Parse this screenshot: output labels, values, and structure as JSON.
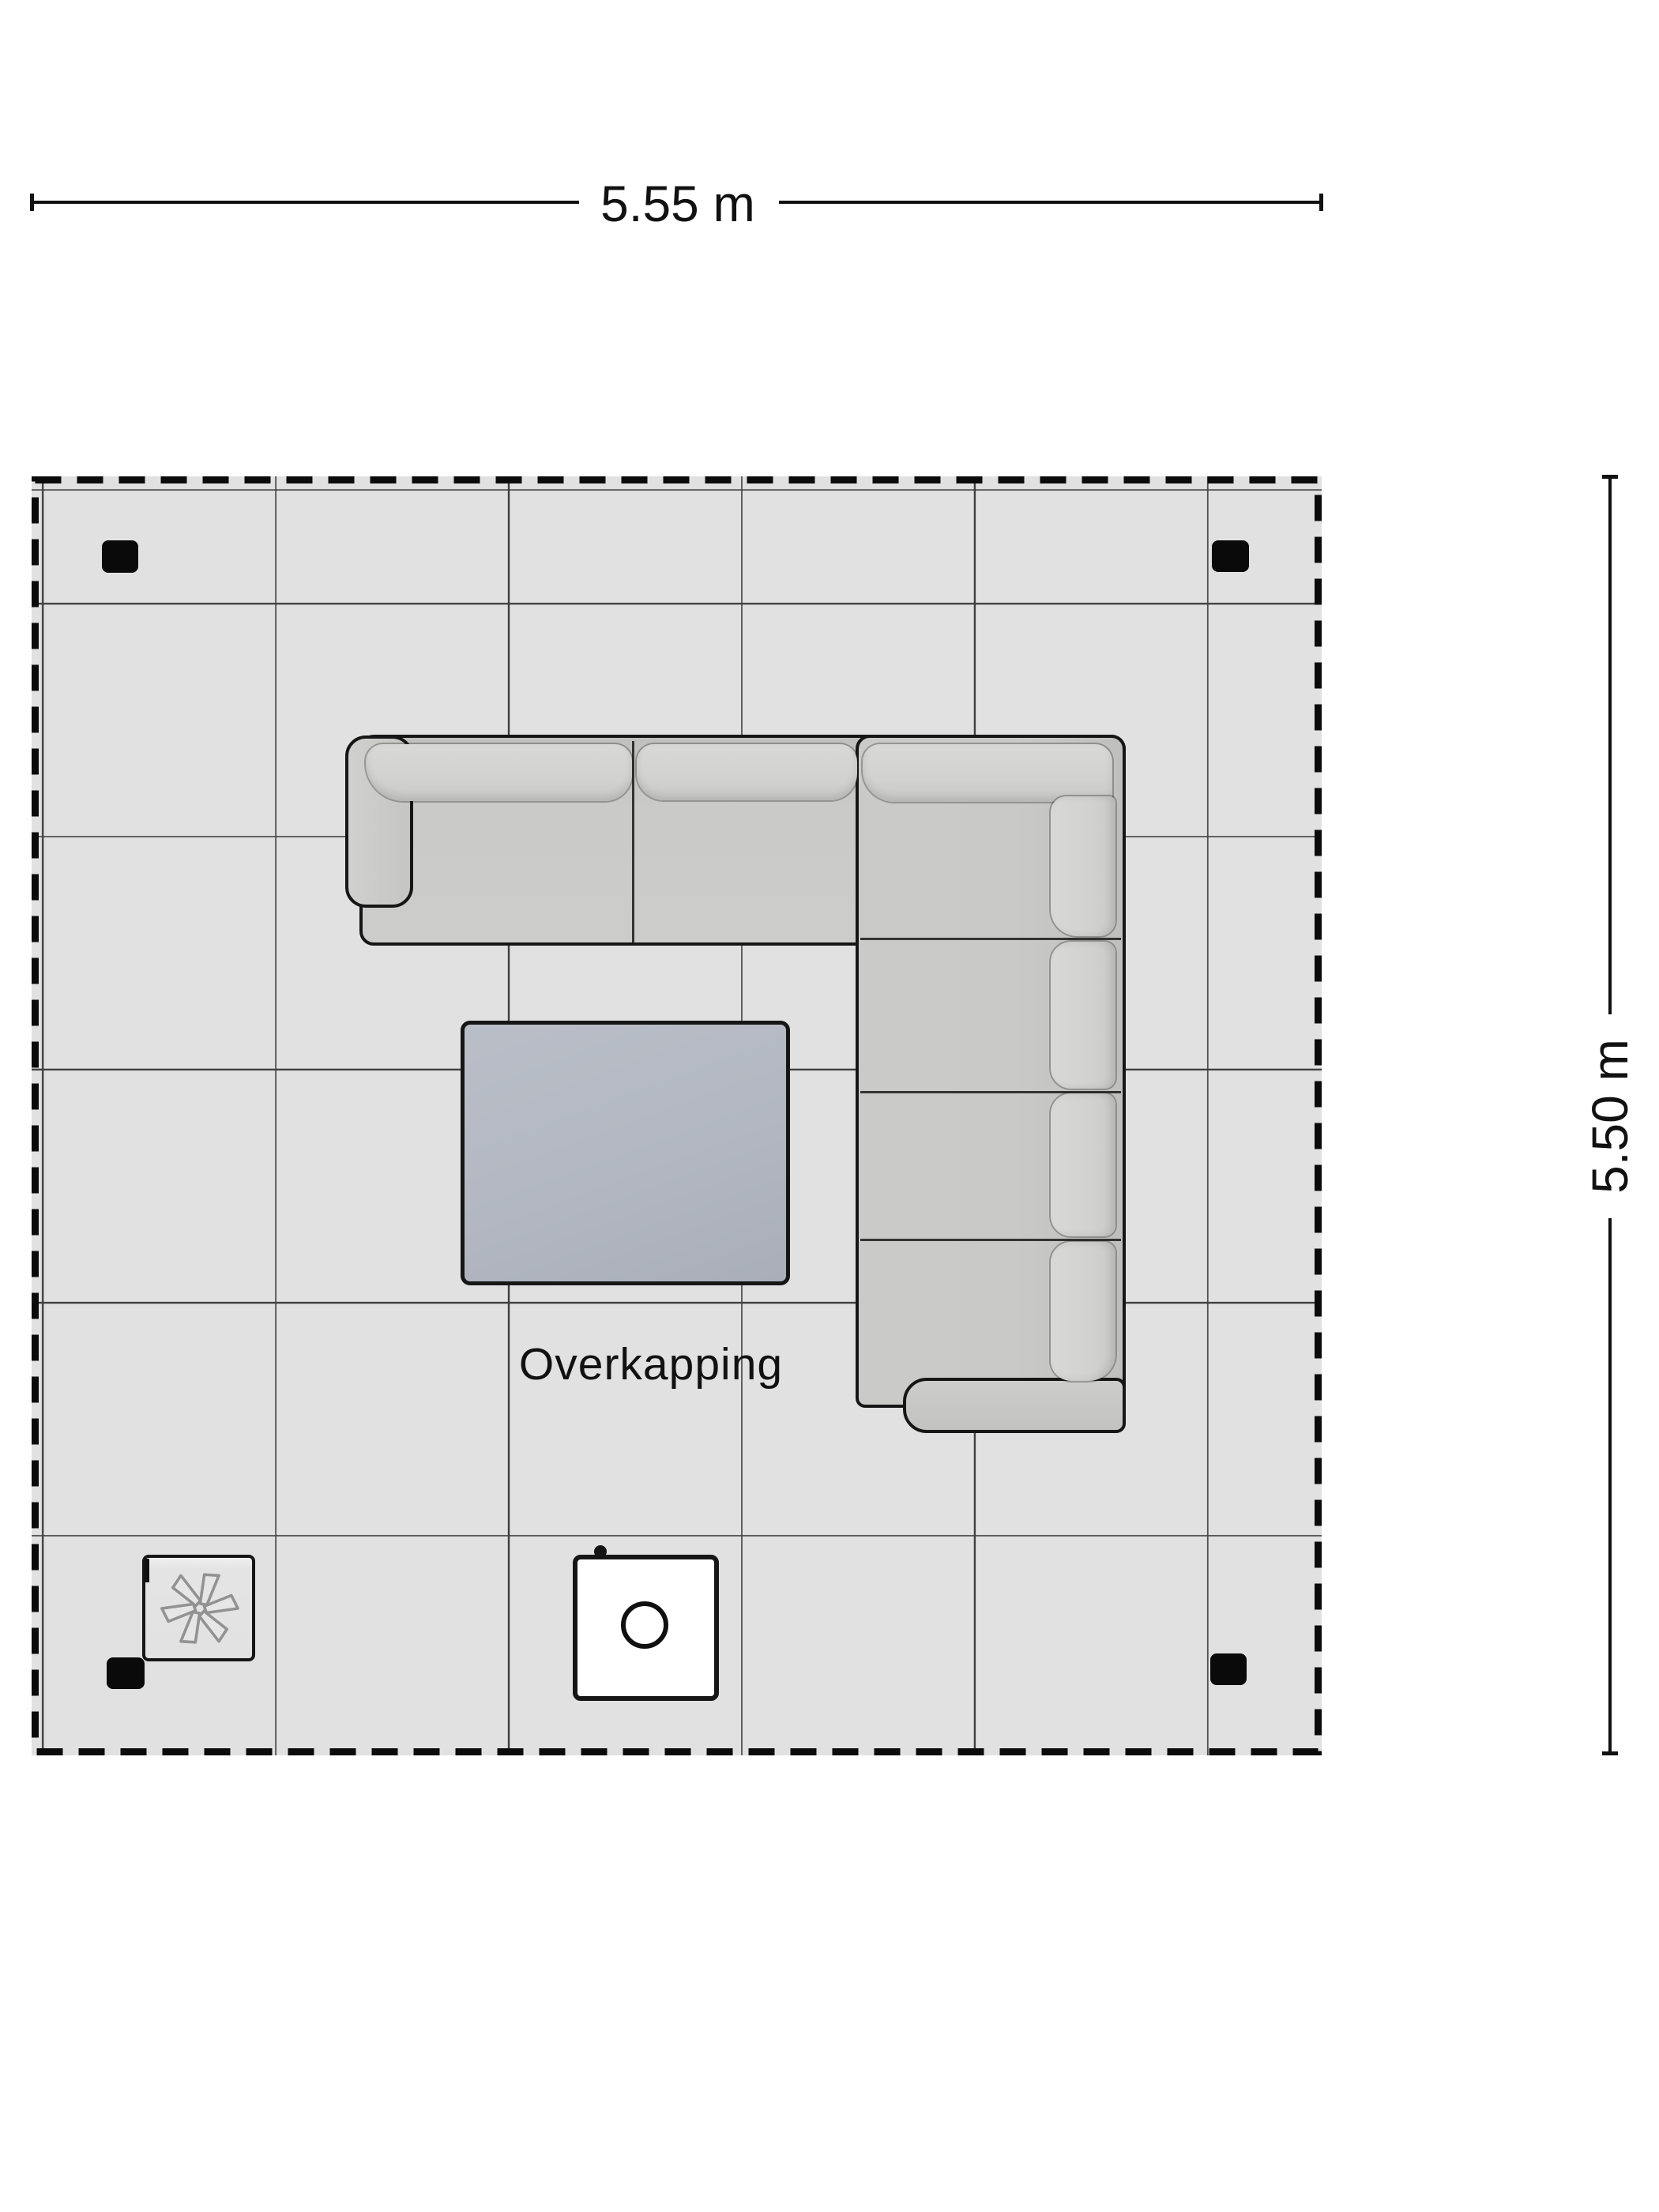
{
  "plan": {
    "room": {
      "label": "Overkapping"
    },
    "dimensions": {
      "width_label": "5.55 m",
      "height_label": "5.50 m"
    },
    "furniture": {
      "sofa": "corner-sofa",
      "table": "coffee-table",
      "fire_table": "fire-table",
      "heater": "patio-heater",
      "post_count": 4
    },
    "colors": {
      "floor": "#e1e1e1",
      "grid": "#3e3e3e",
      "outline": "#161616",
      "post": "#0a0a0a",
      "text": "#111111"
    }
  }
}
